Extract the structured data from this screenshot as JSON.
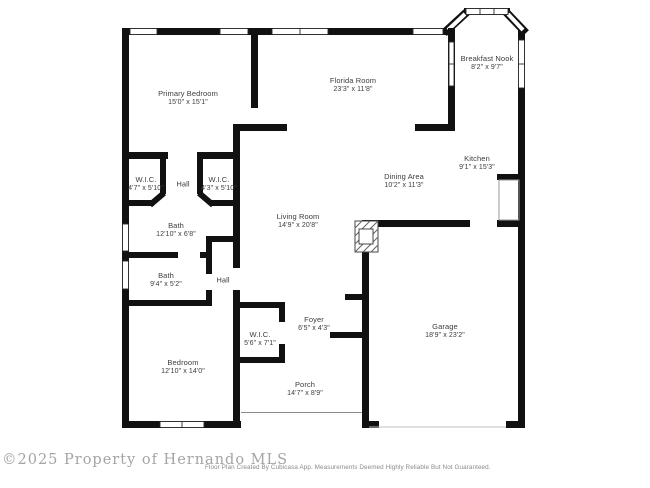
{
  "footer": {
    "watermark": "©2025 Property of Hernando MLS",
    "disclaimer": "Floor Plan Created By Cubicasa App. Measurements Deemed Highly Reliable But Not Guaranteed."
  },
  "colors": {
    "wall": "#111111",
    "label_text": "#3c3c3c",
    "watermark_text": "#a4a4a4"
  },
  "rooms": [
    {
      "name": "Primary Bedroom",
      "dims": "15'0\" x 15'1\""
    },
    {
      "name": "Florida Room",
      "dims": "23'3\" x 11'8\""
    },
    {
      "name": "Breakfast Nook",
      "dims": "8'2\" x 9'7\""
    },
    {
      "name": "Kitchen",
      "dims": "9'1\" x 15'3\""
    },
    {
      "name": "Dining Area",
      "dims": "10'2\" x 11'3\""
    },
    {
      "name": "Living Room",
      "dims": "14'9\" x 20'8\""
    },
    {
      "name": "W.I.C.",
      "dims": "4'7\" x 5'10\""
    },
    {
      "name": "Hall",
      "dims": ""
    },
    {
      "name": "W.I.C.",
      "dims": "4'3\" x 5'10\""
    },
    {
      "name": "Bath",
      "dims": "12'10\" x 6'8\""
    },
    {
      "name": "Bath",
      "dims": "9'4\" x 5'2\""
    },
    {
      "name": "Hall",
      "dims": ""
    },
    {
      "name": "Bedroom",
      "dims": "12'10\" x 14'0\""
    },
    {
      "name": "W.I.C.",
      "dims": "5'6\" x 7'1\""
    },
    {
      "name": "Foyer",
      "dims": "6'5\" x 4'3\""
    },
    {
      "name": "Porch",
      "dims": "14'7\" x 8'9\""
    },
    {
      "name": "Garage",
      "dims": "18'9\" x 23'2\""
    }
  ]
}
